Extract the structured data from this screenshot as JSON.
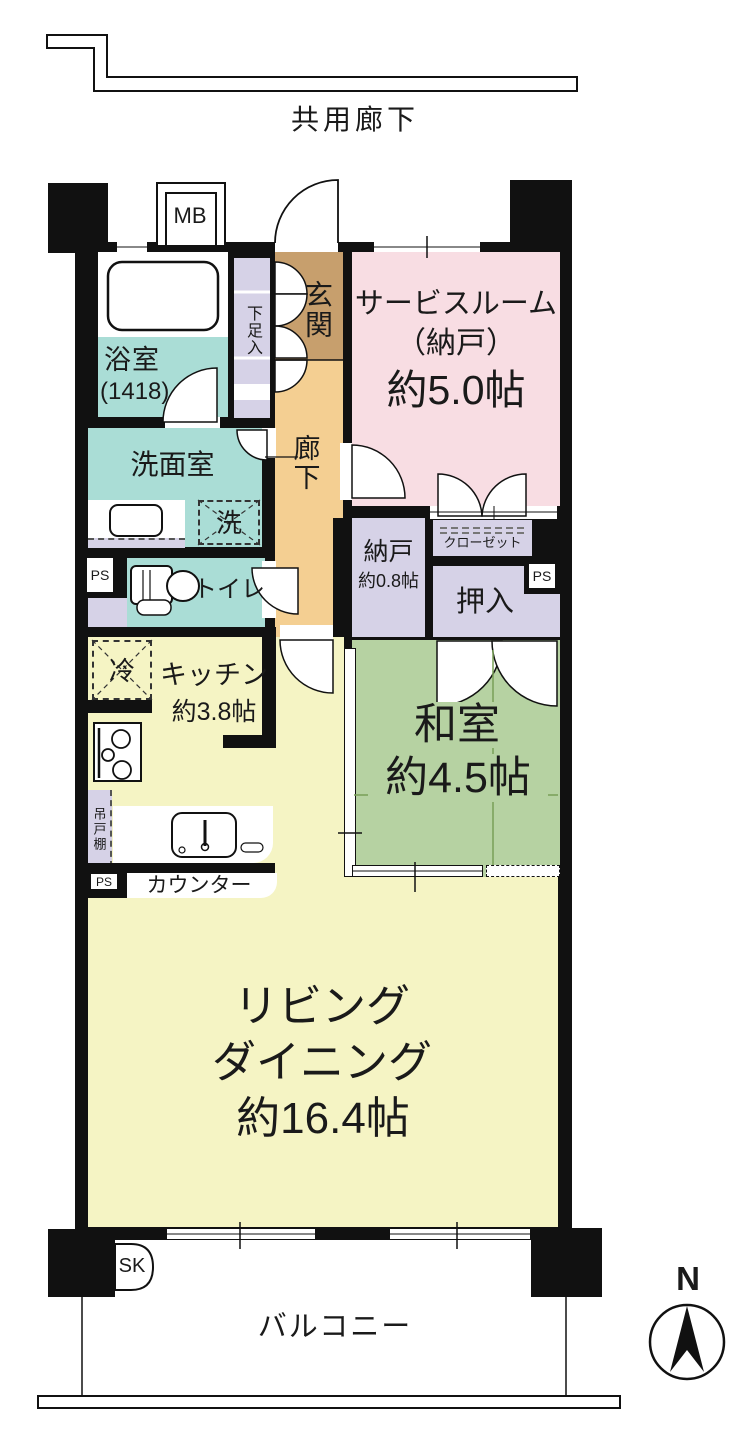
{
  "title": "共用廊下",
  "compass": {
    "north_label": "N"
  },
  "rooms": {
    "service": {
      "name": "サービスルーム",
      "sub": "（納戸）",
      "size": "約5.0帖"
    },
    "washitsu": {
      "name": "和室",
      "size": "約4.5帖"
    },
    "living": {
      "line1": "リビング",
      "line2": "ダイニング",
      "size": "約16.4帖"
    },
    "kitchen": {
      "name": "キッチン",
      "size": "約3.8帖"
    },
    "bath": {
      "name": "浴室",
      "size": "(1418)"
    },
    "washroom": {
      "name": "洗面室"
    },
    "toilet": {
      "name": "トイレ"
    },
    "genkan": {
      "name": "玄関"
    },
    "hall": {
      "name": "廊下"
    },
    "nando": {
      "name": "納戸",
      "size": "約0.8帖"
    },
    "closet": {
      "name": "クローゼット"
    },
    "oshiire": {
      "name": "押入"
    },
    "shoe_cabinet": {
      "name": "下足入"
    },
    "balcony": {
      "name": "バルコニー"
    }
  },
  "fixtures": {
    "meter_box": "MB",
    "pipe_space": "PS",
    "slop_sink": "SK",
    "washer": "洗",
    "fridge": "冷",
    "hanging_cupboard": "吊戸棚",
    "counter": "カウンター"
  },
  "colors": {
    "wall": "#111111",
    "water_rooms_teal": "#aaddd6",
    "storage_lavender": "#d6d2e7",
    "genkan_brown": "#c79f6d",
    "hall_orange": "#f4cf92",
    "service_pink": "#f8dde3",
    "washitsu_green": "#b6d2a2",
    "ld_yellow": "#f5f4c4",
    "tatami_line": "#78a057"
  }
}
